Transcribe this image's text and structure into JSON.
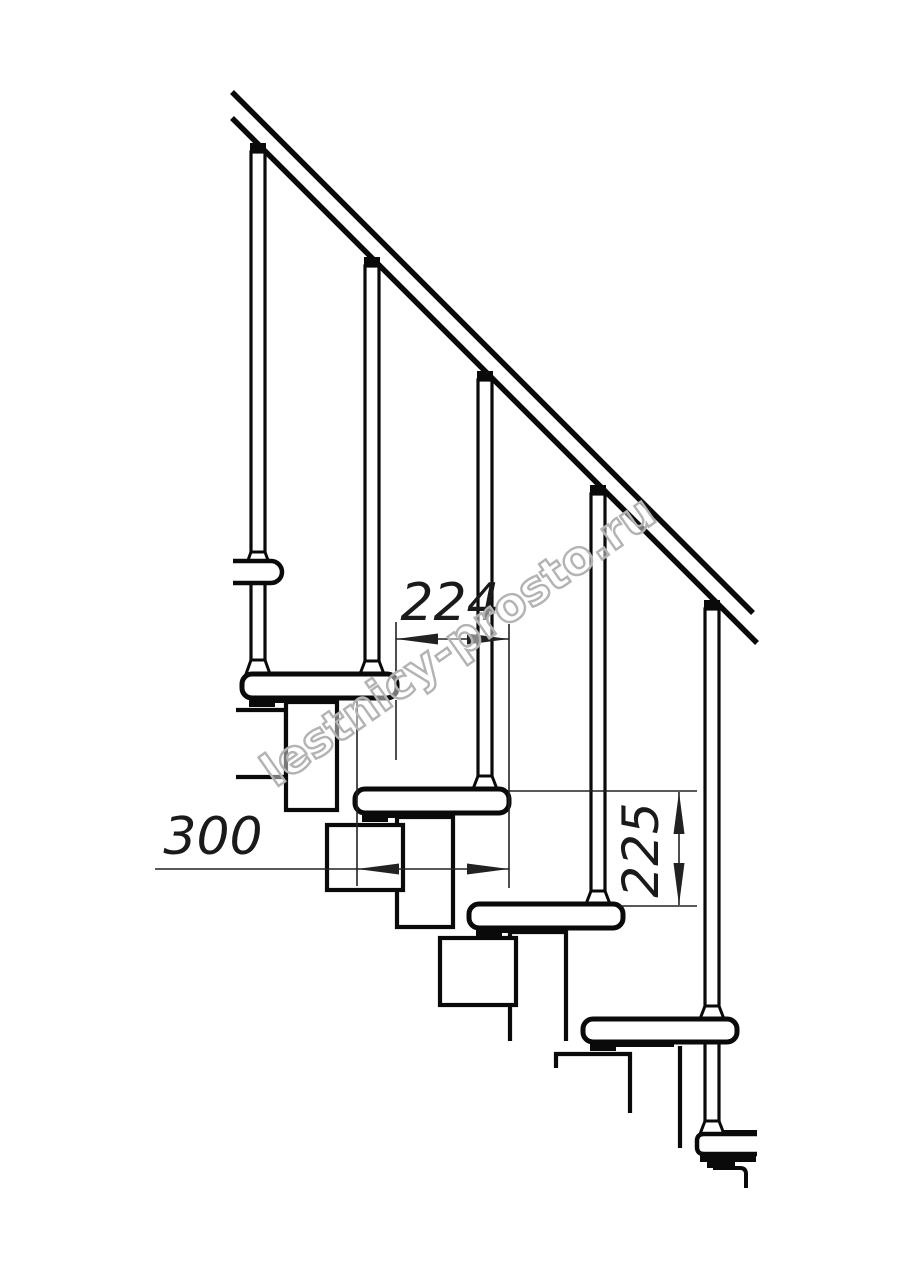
{
  "diagram": {
    "type": "technical-line-drawing",
    "subject": "Modular staircase side elevation with handrail, five balusters, four treads and zigzag module chain",
    "background_color": "#ffffff",
    "line_color": "#0a0a0a",
    "dimension_color": "#222222",
    "labels": {
      "d224": "224",
      "d300": "300",
      "d225": "225"
    },
    "dimensions": [
      {
        "label": "224",
        "orientation": "horizontal",
        "measures": "step run between tread noses"
      },
      {
        "label": "300",
        "orientation": "horizontal",
        "measures": "tread depth"
      },
      {
        "label": "225",
        "orientation": "vertical",
        "measures": "step rise between treads"
      }
    ],
    "watermark": {
      "text": "lestnicy-prosto.ru",
      "color": "#b3b3b3",
      "angle_deg": -35
    }
  }
}
